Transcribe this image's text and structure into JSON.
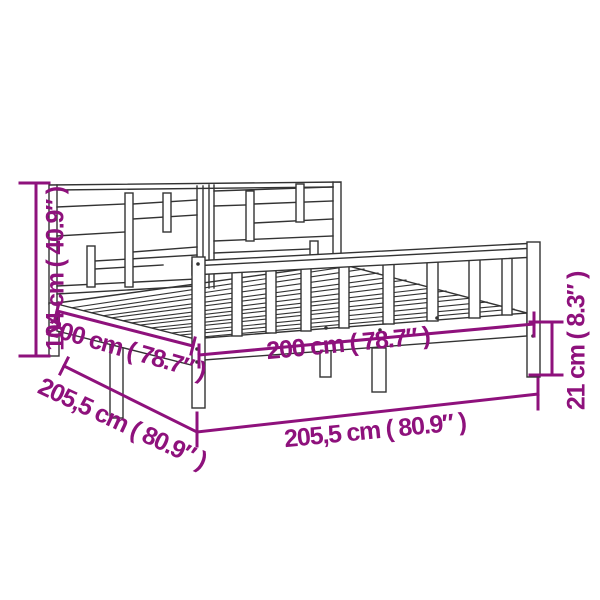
{
  "colors": {
    "accent_magenta": "#8E117C",
    "line_art": "#333333",
    "background": "#FFFFFF"
  },
  "dimensions": {
    "headboard_height": {
      "cm": "104",
      "inches": "40.9",
      "label": "104 cm ( 40.9″ )"
    },
    "inner_length": {
      "cm": "200",
      "inches": "78.7",
      "label": "200 cm ( 78.7″ )"
    },
    "outer_length": {
      "cm": "205,5",
      "inches": "80.9",
      "label": "205,5 cm ( 80.9″ )"
    },
    "inner_width": {
      "cm": "200",
      "inches": "78.7",
      "label": "200 cm ( 78.7″ )"
    },
    "outer_width": {
      "cm": "205,5",
      "inches": "80.9",
      "label": "205,5 cm ( 80.9″ )"
    },
    "rail_height": {
      "cm": "21",
      "inches": "8.3",
      "label": "21 cm ( 8.3″ )"
    }
  }
}
